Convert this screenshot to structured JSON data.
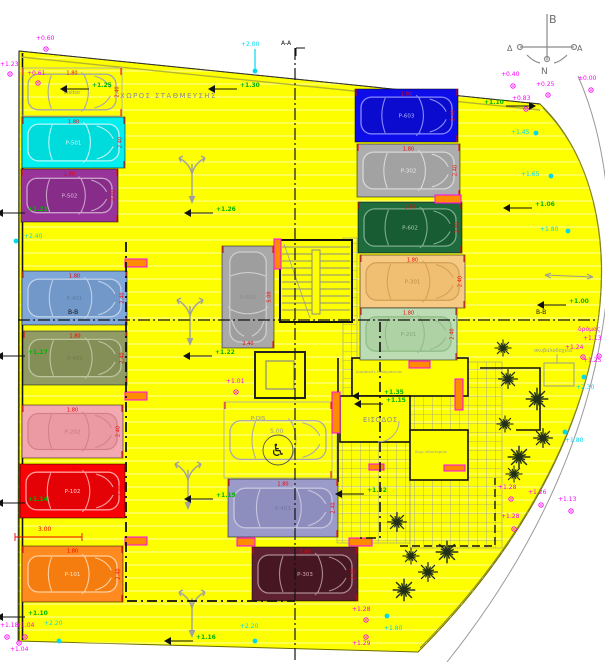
{
  "labels": {
    "area": "ΧΩΡΟΣ ΣΤΑΘΜΕΥΣΗΣ",
    "entrance": "ΕΙΣΟΔΟΣ",
    "bins": "σκυβαλοδοχεία",
    "road": "δρόμος",
    "room_a": "Διαμπερές Μπάρμπεκιου",
    "room_b": "δωμ. πλυντηρίου",
    "section_aa": "A-A",
    "section_bb_left": "B-B",
    "section_bb_right": "B-B"
  },
  "compass": {
    "north": "B",
    "west": "Δ",
    "east": "A",
    "south": "N"
  },
  "colors": {
    "site": "#FDFF00",
    "dim_red": "#F00000",
    "gray_text": "#8C8C8C",
    "marker_magenta": "#FF00FF",
    "marker_green": "#00B400",
    "marker_cyan": "#00D8F0",
    "pier_fill": "#FF8C00",
    "pier_stroke": "#FF00FF",
    "tree": "#22301A",
    "hatch": "#9A9A9A",
    "wall": "#111111"
  },
  "stalls": [
    {
      "id": "visitor",
      "label": "visitor",
      "x": 22,
      "y": 68,
      "w": 100,
      "h": 48,
      "fill": "none",
      "car_fill": "none",
      "car_stroke": "#a8a8a8",
      "label_color": "#8f8f8f",
      "orient": "h",
      "dim_top": "1.80",
      "dim_side": "2.40"
    },
    {
      "id": "p501",
      "label": "P-501",
      "x": 22,
      "y": 117,
      "w": 103,
      "h": 51,
      "fill": "#00EFEF",
      "car_fill": "#00DCDC",
      "car_stroke": "#bdf6f6",
      "label_color": "#d8fbfb",
      "orient": "h",
      "dim_top": "1.80",
      "dim_side": "2.40"
    },
    {
      "id": "p502",
      "label": "P-502",
      "x": 21,
      "y": 169,
      "w": 97,
      "h": 53,
      "fill": "#98339A",
      "car_fill": "#872D89",
      "car_stroke": "#c9a0ca",
      "label_color": "#ddc0de",
      "orient": "h",
      "dim_top": "1.80",
      "dim_side": "2.40"
    },
    {
      "id": "p401",
      "label": "P-401",
      "x": 22,
      "y": 271,
      "w": 105,
      "h": 54,
      "fill": "#7FA7D9",
      "car_fill": "#7198c9",
      "car_stroke": "#bed0e8",
      "label_color": "#5f7da6",
      "orient": "h",
      "dim_top": "1.80",
      "dim_side": "2.40"
    },
    {
      "id": "p402",
      "label": "P-402",
      "x": 23,
      "y": 331,
      "w": 104,
      "h": 54,
      "fill": "#909C64",
      "car_fill": "#848f58",
      "car_stroke": "#bcc4a0",
      "label_color": "#6e7a48",
      "orient": "h",
      "dim_top": "1.80",
      "dim_side": "2.40"
    },
    {
      "id": "p202",
      "label": "P-202",
      "x": 22,
      "y": 405,
      "w": 101,
      "h": 53,
      "fill": "#F3A9B1",
      "car_fill": "#eb9aa3",
      "car_stroke": "#d3808a",
      "label_color": "#c4717c",
      "orient": "h",
      "dim_top": "1.80",
      "dim_side": "2.40"
    },
    {
      "id": "p102",
      "label": "P-102",
      "x": 20,
      "y": 464,
      "w": 105,
      "h": 54,
      "fill": "#FB0207",
      "car_fill": "#e50206",
      "car_stroke": "#ff9d9d",
      "label_color": "#ffd6d6",
      "orient": "h",
      "dim_top": "1.80",
      "dim_side": "2.40"
    },
    {
      "id": "p101",
      "label": "P-101",
      "x": 22,
      "y": 546,
      "w": 101,
      "h": 56,
      "fill": "#FF8A1F",
      "car_fill": "#f57d10",
      "car_stroke": "#ffd0a0",
      "label_color": "#ffe6c8",
      "orient": "h",
      "dim_top": "1.80",
      "dim_side": "2.40"
    },
    {
      "id": "p603",
      "label": "P-603",
      "x": 355,
      "y": 89,
      "w": 103,
      "h": 53,
      "fill": "#0D0DE9",
      "car_fill": "#0b0bcf",
      "car_stroke": "#8a8aff",
      "label_color": "#b8b8ff",
      "orient": "h",
      "dim_top": "1.80",
      "dim_side": "2.40"
    },
    {
      "id": "p302",
      "label": "P-302",
      "x": 357,
      "y": 144,
      "w": 103,
      "h": 53,
      "fill": "#ADADAD",
      "car_fill": "#a2a2a2",
      "car_stroke": "#d8d8d8",
      "label_color": "#e9e9e9",
      "orient": "h",
      "dim_top": "1.80",
      "dim_side": "2.40"
    },
    {
      "id": "p602",
      "label": "P-602",
      "x": 358,
      "y": 202,
      "w": 104,
      "h": 51,
      "fill": "#1E6B3E",
      "car_fill": "#185c34",
      "car_stroke": "#7bac8e",
      "label_color": "#abccb7",
      "orient": "h",
      "dim_top": "1.80",
      "dim_side": "2.40"
    },
    {
      "id": "p301",
      "label": "P-301",
      "x": 360,
      "y": 255,
      "w": 105,
      "h": 53,
      "fill": "#F7CA84",
      "car_fill": "#f0bf71",
      "car_stroke": "#d5a259",
      "label_color": "#b98f49",
      "orient": "h",
      "dim_top": "1.80",
      "dim_side": "2.40"
    },
    {
      "id": "p201",
      "label": "P-201",
      "x": 360,
      "y": 308,
      "w": 97,
      "h": 52,
      "fill": "#BCDCB3",
      "car_fill": "#afd2a5",
      "car_stroke": "#90bd88",
      "label_color": "#7fa878",
      "orient": "h",
      "dim_top": "1.80",
      "dim_side": "2.40"
    },
    {
      "id": "p601",
      "label": "P-601",
      "x": 222,
      "y": 246,
      "w": 52,
      "h": 102,
      "fill": "#A9A9A9",
      "car_fill": "#9e9e9e",
      "car_stroke": "#cecece",
      "label_color": "#8b8b8b",
      "orient": "v",
      "dim_bottom": "2.40",
      "dim_side": "5.00"
    },
    {
      "id": "pdis",
      "label": "P-DIS",
      "x": 224,
      "y": 402,
      "w": 108,
      "h": 76,
      "fill": "none",
      "car_fill": "none",
      "car_stroke": "#aaaaaa",
      "label_color": "#8f8f8f",
      "orient": "h",
      "lx": 258,
      "ly": 420
    },
    {
      "id": "p403",
      "label": "P-403",
      "x": 228,
      "y": 479,
      "w": 110,
      "h": 58,
      "fill": "#9B9BC9",
      "car_fill": "#8e8ebe",
      "car_stroke": "#c6c6df",
      "label_color": "#74749e",
      "orient": "h",
      "dim_top": "1.80",
      "dim_side": "2.40"
    },
    {
      "id": "p303",
      "label": "P-303",
      "x": 252,
      "y": 547,
      "w": 106,
      "h": 54,
      "fill": "#5D2131",
      "car_fill": "#471623",
      "car_stroke": "#ab8a93",
      "label_color": "#cfaab3",
      "orient": "h",
      "dim_top": "1.80",
      "dim_side": "2.40"
    }
  ],
  "markers": {
    "magenta": [
      {
        "t": "+0.60",
        "x": 36,
        "y": 40,
        "dot": [
          46,
          49
        ]
      },
      {
        "t": "+1.23",
        "x": 0,
        "y": 66,
        "dot": [
          10,
          74
        ]
      },
      {
        "t": "+0.61",
        "x": 27,
        "y": 75,
        "dot": [
          38,
          83
        ]
      },
      {
        "t": "+0.40",
        "x": 501,
        "y": 76,
        "dot": [
          513,
          86
        ]
      },
      {
        "t": "+0.25",
        "x": 536,
        "y": 86,
        "dot": [
          548,
          95
        ]
      },
      {
        "t": "±0.00",
        "x": 578,
        "y": 80,
        "dot": [
          591,
          90
        ]
      },
      {
        "t": "+0.83",
        "x": 512,
        "y": 100,
        "dot": [
          526,
          109
        ]
      },
      {
        "t": "+1.01",
        "x": 226,
        "y": 383,
        "dot": [
          236,
          392
        ]
      },
      {
        "t": "+1.18",
        "x": 0,
        "y": 627,
        "dot": [
          7,
          637
        ]
      },
      {
        "t": "+1.04",
        "x": 16,
        "y": 627,
        "dot": [
          25,
          637
        ]
      },
      {
        "t": "+1.04",
        "x": 10,
        "y": 651,
        "dot": [
          19,
          643
        ]
      },
      {
        "t": "+1.13",
        "x": 583,
        "y": 340,
        "dot": null
      },
      {
        "t": "+1.24",
        "x": 565,
        "y": 349,
        "dot": [
          583,
          357
        ]
      },
      {
        "t": "+1.25",
        "x": 583,
        "y": 362,
        "dot": [
          599,
          356
        ]
      },
      {
        "t": "+1.28",
        "x": 498,
        "y": 489,
        "dot": [
          511,
          499
        ]
      },
      {
        "t": "+1.26",
        "x": 528,
        "y": 494,
        "dot": [
          541,
          505
        ]
      },
      {
        "t": "+1.13",
        "x": 558,
        "y": 501,
        "dot": [
          571,
          511
        ]
      },
      {
        "t": "+1.28",
        "x": 501,
        "y": 518,
        "dot": [
          514,
          529
        ]
      },
      {
        "t": "+1.28",
        "x": 352,
        "y": 611,
        "dot": [
          366,
          620
        ]
      },
      {
        "t": "+1.29",
        "x": 352,
        "y": 645,
        "dot": [
          366,
          637
        ]
      }
    ],
    "green": [
      {
        "t": "+1.25",
        "x": 92,
        "y": 87
      },
      {
        "t": "+1.30",
        "x": 240,
        "y": 87
      },
      {
        "t": "+1.21",
        "x": 28,
        "y": 211
      },
      {
        "t": "+1.26",
        "x": 216,
        "y": 211
      },
      {
        "t": "+1.17",
        "x": 28,
        "y": 354
      },
      {
        "t": "+1.22",
        "x": 215,
        "y": 354
      },
      {
        "t": "+1.19",
        "x": 216,
        "y": 497
      },
      {
        "t": "+1.14",
        "x": 28,
        "y": 501
      },
      {
        "t": "+1.10",
        "x": 28,
        "y": 615
      },
      {
        "t": "+1.16",
        "x": 196,
        "y": 639
      },
      {
        "t": "+1.35",
        "x": 384,
        "y": 394
      },
      {
        "t": "+1.15",
        "x": 386,
        "y": 402
      },
      {
        "t": "+1.32",
        "x": 367,
        "y": 492
      },
      {
        "t": "+1.10",
        "x": 484,
        "y": 104,
        "flag": "r"
      },
      {
        "t": "+1.06",
        "x": 535,
        "y": 206
      },
      {
        "t": "+1.00",
        "x": 569,
        "y": 303
      }
    ],
    "cyan": [
      {
        "t": "+2.00",
        "x": 241,
        "y": 46,
        "dot": [
          255,
          71
        ],
        "line": [
          255,
          49,
          255,
          70
        ]
      },
      {
        "t": "+2.40",
        "x": 24,
        "y": 238,
        "dot": [
          16,
          241
        ]
      },
      {
        "t": "+1.45",
        "x": 511,
        "y": 134,
        "dot": [
          536,
          133
        ]
      },
      {
        "t": "+1.65",
        "x": 521,
        "y": 176,
        "dot": [
          551,
          176
        ]
      },
      {
        "t": "+1.80",
        "x": 540,
        "y": 231,
        "dot": [
          568,
          231
        ]
      },
      {
        "t": "+2.30",
        "x": 576,
        "y": 389,
        "dot": [
          584,
          377
        ]
      },
      {
        "t": "+1.80",
        "x": 565,
        "y": 442,
        "dot": [
          565,
          432
        ]
      },
      {
        "t": "+2.20",
        "x": 44,
        "y": 625,
        "dot": [
          59,
          641
        ]
      },
      {
        "t": "+2.20",
        "x": 240,
        "y": 628,
        "dot": [
          255,
          641
        ]
      },
      {
        "t": "+1.80",
        "x": 384,
        "y": 630,
        "dot": [
          387,
          616
        ]
      }
    ]
  },
  "dimensions": [
    {
      "text": "3.00",
      "x": 38,
      "y": 531,
      "line": [
        15,
        537,
        82,
        537
      ],
      "color": "red"
    },
    {
      "text": "5.00",
      "x": 270,
      "y": 433,
      "color": "gray"
    }
  ],
  "trees": [
    [
      503,
      348
    ],
    [
      508,
      379
    ],
    [
      537,
      399
    ],
    [
      505,
      424
    ],
    [
      543,
      438
    ],
    [
      519,
      457
    ],
    [
      514,
      474
    ],
    [
      397,
      522
    ],
    [
      447,
      552
    ],
    [
      411,
      556
    ],
    [
      428,
      572
    ],
    [
      404,
      590
    ]
  ],
  "drive_arrows": [
    [
      192,
      164
    ],
    [
      190,
      306
    ],
    [
      188,
      470
    ],
    [
      192,
      598
    ]
  ],
  "piers": [
    [
      125,
      259,
      22,
      8
    ],
    [
      125,
      392,
      22,
      8
    ],
    [
      125,
      537,
      22,
      8
    ],
    [
      237,
      538,
      18,
      8
    ],
    [
      349,
      538,
      23,
      8
    ],
    [
      435,
      195,
      26,
      8
    ],
    [
      332,
      392,
      8,
      41
    ],
    [
      455,
      379,
      8,
      31
    ],
    [
      274,
      239,
      7,
      30
    ],
    [
      409,
      361,
      21,
      7
    ],
    [
      369,
      464,
      15,
      6
    ],
    [
      444,
      465,
      21,
      6
    ]
  ],
  "wheelchair": {
    "glyph": "♿"
  }
}
